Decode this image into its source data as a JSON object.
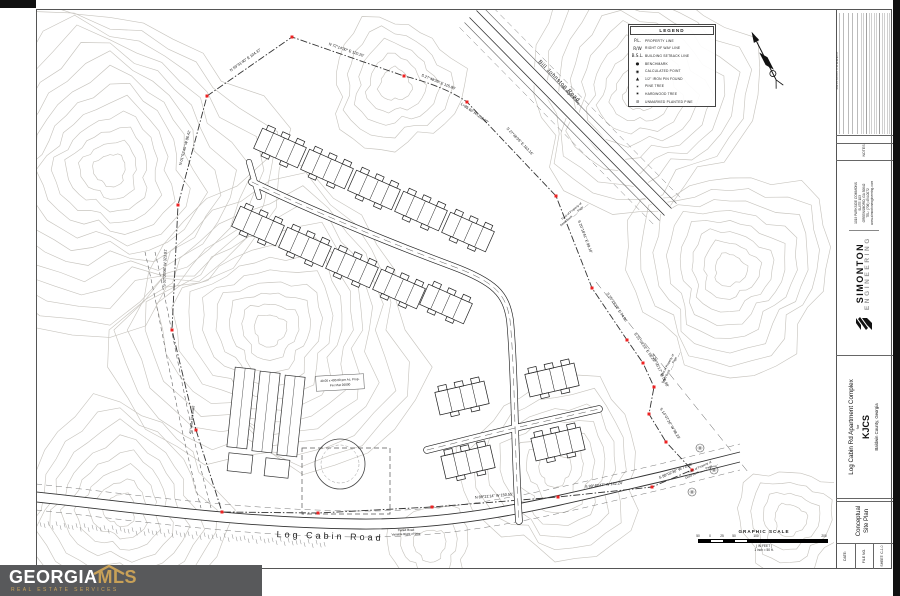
{
  "legend": {
    "title": "LEGEND",
    "items": [
      {
        "symbol": "P.L.",
        "label": "PROPERTY LINE"
      },
      {
        "symbol": "R/W",
        "label": "RIGHT OF WAY LINE"
      },
      {
        "symbol": "B.S.L.",
        "label": "BUILDING SETBACK LINE"
      },
      {
        "symbol": "●",
        "label": "BENCHMARK"
      },
      {
        "symbol": "◉",
        "label": "CALCULATED POINT"
      },
      {
        "symbol": "▲",
        "label": "1/2\" IRON PIN FOUND"
      },
      {
        "symbol": "✶",
        "label": "PINE TREE"
      },
      {
        "symbol": "✷",
        "label": "HARDWOOD TREE"
      },
      {
        "symbol": "⊘",
        "label": "UNMARKED PLANTED PINE"
      }
    ]
  },
  "scale": {
    "title": "GRAPHIC SCALE",
    "ticks": [
      "50",
      "0",
      "25",
      "50",
      "100",
      "200"
    ],
    "unit_note": "( IN FEET )",
    "ratio_note": "1 inch = 50 ft."
  },
  "roads": {
    "bill_johnston": "Bill Johnston Road",
    "bill_johnston_row": "60' Right of Way",
    "log_cabin": "Log Cabin Road",
    "log_cabin_note1": "Paved Road",
    "log_cabin_note2": "Variable Right of Way",
    "dirt_road": "40' Wide Dirt Road"
  },
  "bearings": [
    "N 59°31'40\" E  104.37'",
    "N 72°14'30\" E  120.20'",
    "S 27°48'35\" E  115.80'",
    "L=85.60'  R=230.00'",
    "S 27°48'35\" E  163.16'",
    "S 20°18'41\" E  99.10'",
    "S 25°29'38\" E  74.86'",
    "S 21°09'29\" E  58.21'",
    "S 29°05'17\" W  56.98'",
    "S 14°07'26\" W  98.23'",
    "S 88°02'30\" W  73.08'",
    "S 89°49'47\" W  132.24'",
    "N 89°21'14\" W  150.55'",
    "S 02°05'08\" W  323.81'",
    "N 01°52'45\" W  86.41'"
  ],
  "annotations": {
    "tract_line1": "Tract of Property of",
    "tract_line2": "Deed Book ___, Page ___",
    "barn_line1": "40.00 x 400.00 per Ac. Prop.",
    "barn_line2": "Per Plat 20000"
  },
  "titleblock": {
    "revision_label": "REVISION COMMENT",
    "notes_label": "NOTES:",
    "company": {
      "name": "SIMONTON",
      "name2": "ENGINEERING",
      "addr1": "1019 PARKSIDE COMMONS",
      "addr2": "SUITE 103",
      "addr3": "GREENSBORO, GA 30642",
      "addr4": "TEL: (706) 454-0072",
      "addr5": "www.simontonengineering.com"
    },
    "project": {
      "line1": "Log Cabin Rd Apartment Complex",
      "line2": "for",
      "line3": "KJCS",
      "line4": "Baldwin County, Georgia"
    },
    "sheet_title1": "Conceptual",
    "sheet_title2": "Site Plan",
    "meta": [
      {
        "label": "DATE:"
      },
      {
        "label": "FILE NO."
      },
      {
        "label": "SHEET: C-1.0"
      }
    ]
  },
  "watermark": {
    "name1": "GEORGIA",
    "name2": "MLS",
    "tagline": "REAL ESTATE SERVICES"
  }
}
